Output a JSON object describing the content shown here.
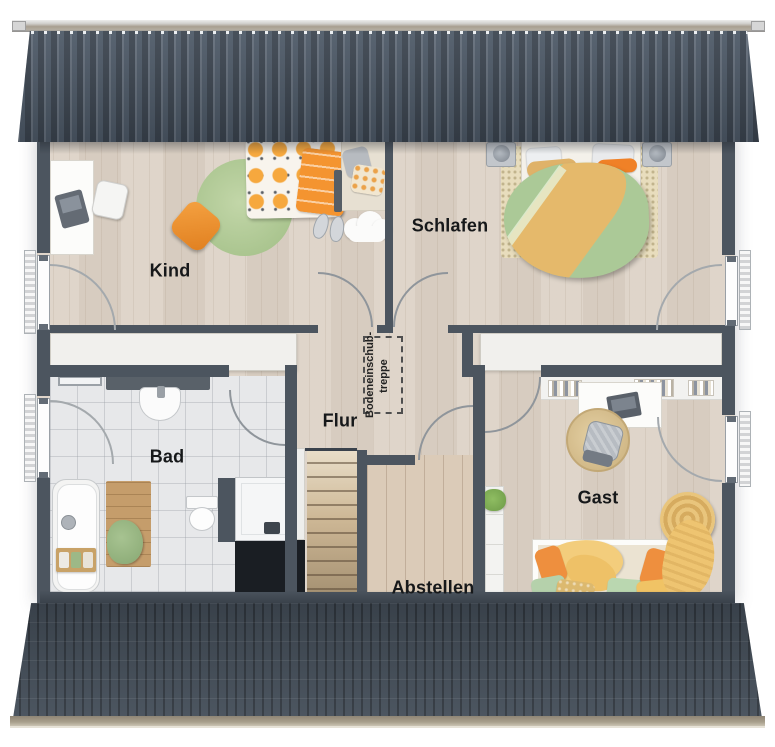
{
  "meta": {
    "type": "architectural floor plan",
    "style": "3d rendered top-down view, attic storey with roof bands top and bottom",
    "language": "de"
  },
  "rooms": [
    {
      "id": "kind",
      "label": "Kind"
    },
    {
      "id": "schlafen",
      "label": "Schlafen"
    },
    {
      "id": "bad",
      "label": "Bad"
    },
    {
      "id": "flur",
      "label": "Flur"
    },
    {
      "id": "abstellen",
      "label": "Abstellen"
    },
    {
      "id": "gast",
      "label": "Gast"
    }
  ],
  "annotations": {
    "attic_ladder": {
      "line1": "Bodeneinschub-",
      "line2": "treppe"
    }
  },
  "palette": {
    "roof": "#4c5866",
    "roof_bottom": "#454f5a",
    "ridge": "#a79e90",
    "wall": "#4c555f",
    "floor_wood": "#ddd3c7",
    "floor_storage": "#dbcbb8",
    "bath_tile": "#e7e8ea",
    "white_band": "#f1f0ed",
    "accent_orange": "#f0953b",
    "accent_green": "#abc997",
    "accent_yellow": "#f2cd7e",
    "void_dark": "#1a1e23"
  },
  "furniture": {
    "kind": [
      "desk",
      "office-chair",
      "round-rug",
      "pouf",
      "single-bed",
      "cloud-rug",
      "slippers"
    ],
    "schlafen": [
      "double-bed",
      "nightstand-left",
      "nightstand-right",
      "area-rug"
    ],
    "bad": [
      "towel-rail",
      "washbasin",
      "toilet",
      "bathtub",
      "bath-mat",
      "shower"
    ],
    "flur": [
      "staircase",
      "attic-ladder-hatch"
    ],
    "gast": [
      "book-shelf",
      "desk",
      "office-chair",
      "round-rug",
      "daybed",
      "pouf",
      "storage-shelf",
      "plant"
    ]
  },
  "windows": [
    "kind-left",
    "bad-left",
    "schlafen-right",
    "gast-right"
  ]
}
